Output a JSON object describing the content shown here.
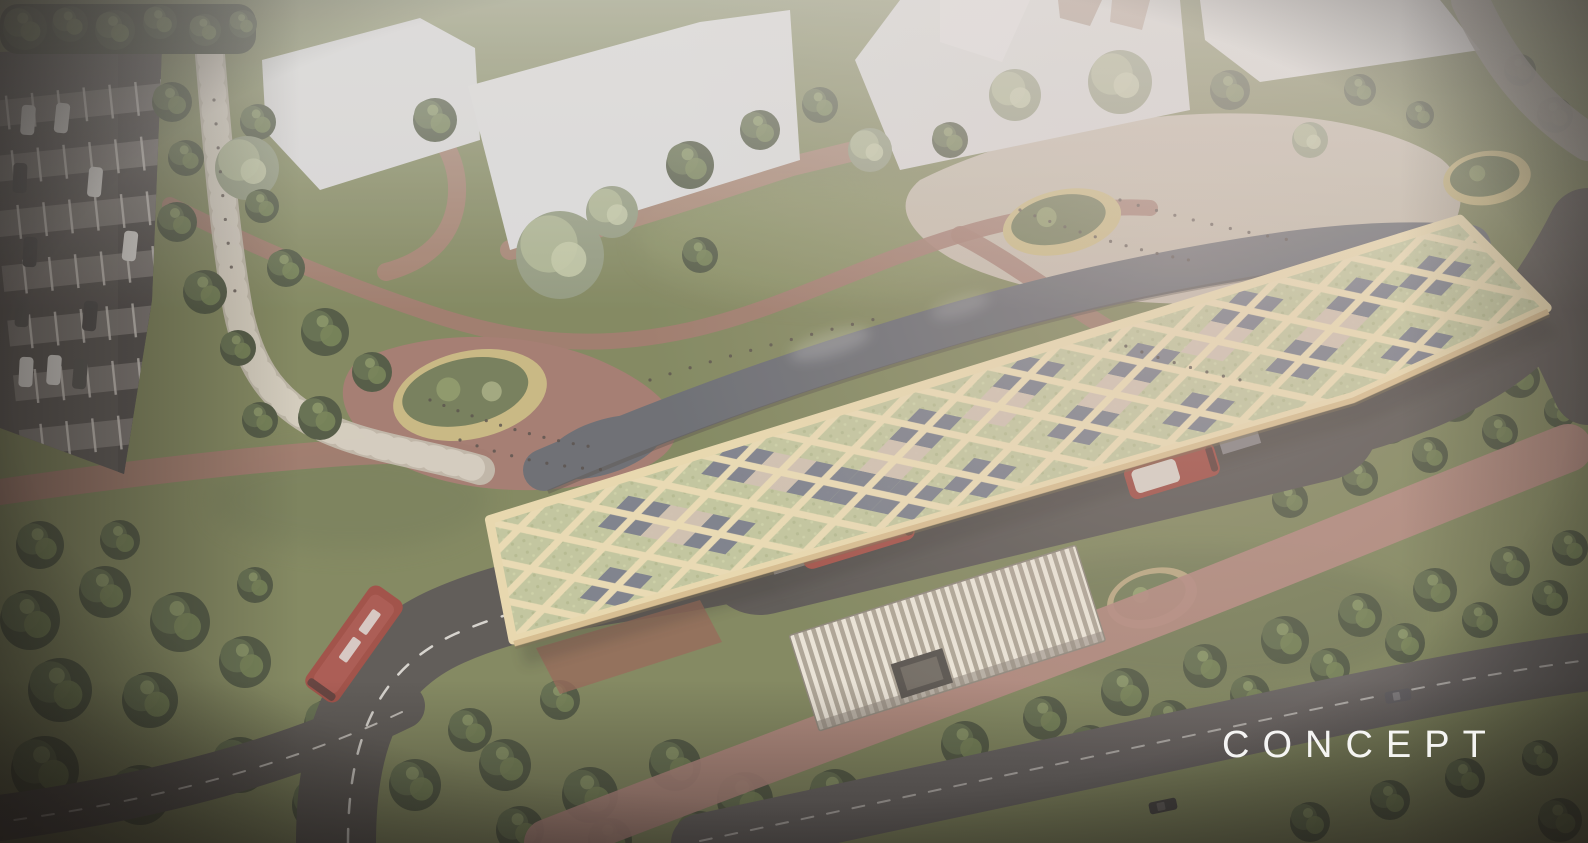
{
  "image": {
    "kind": "architectural aerial concept rendering",
    "subject": "bus interchange with diamond-lattice green roof canopy set in a landscaped park with winding terracotta paths, ponds, planters, a parking strip, tree-lined roads, cycle path and red buses",
    "watermark": {
      "label": "CONCEPT",
      "color": "#ffffff"
    }
  },
  "palette": {
    "grass": "#7b8257",
    "tree_dark": "#47503a",
    "tree_pale": "#9aa37c",
    "path_red": "#9f7468",
    "cycle_path_pink": "#b0837a",
    "plaza_light": "#c8bdb0",
    "road_dark": "#54504d",
    "water": "#63666d",
    "building_white": "#dbdbdc",
    "canopy_lattice_cream": "#edddb3",
    "roof_planting_green": "#c2c79c",
    "roof_glass_dark": "#737887",
    "roof_skylight_tan": "#d2c1b1",
    "planter_rim_yellow": "#c9b87e",
    "bus_red": "#9c453c",
    "car_white": "#e6e4e0"
  }
}
